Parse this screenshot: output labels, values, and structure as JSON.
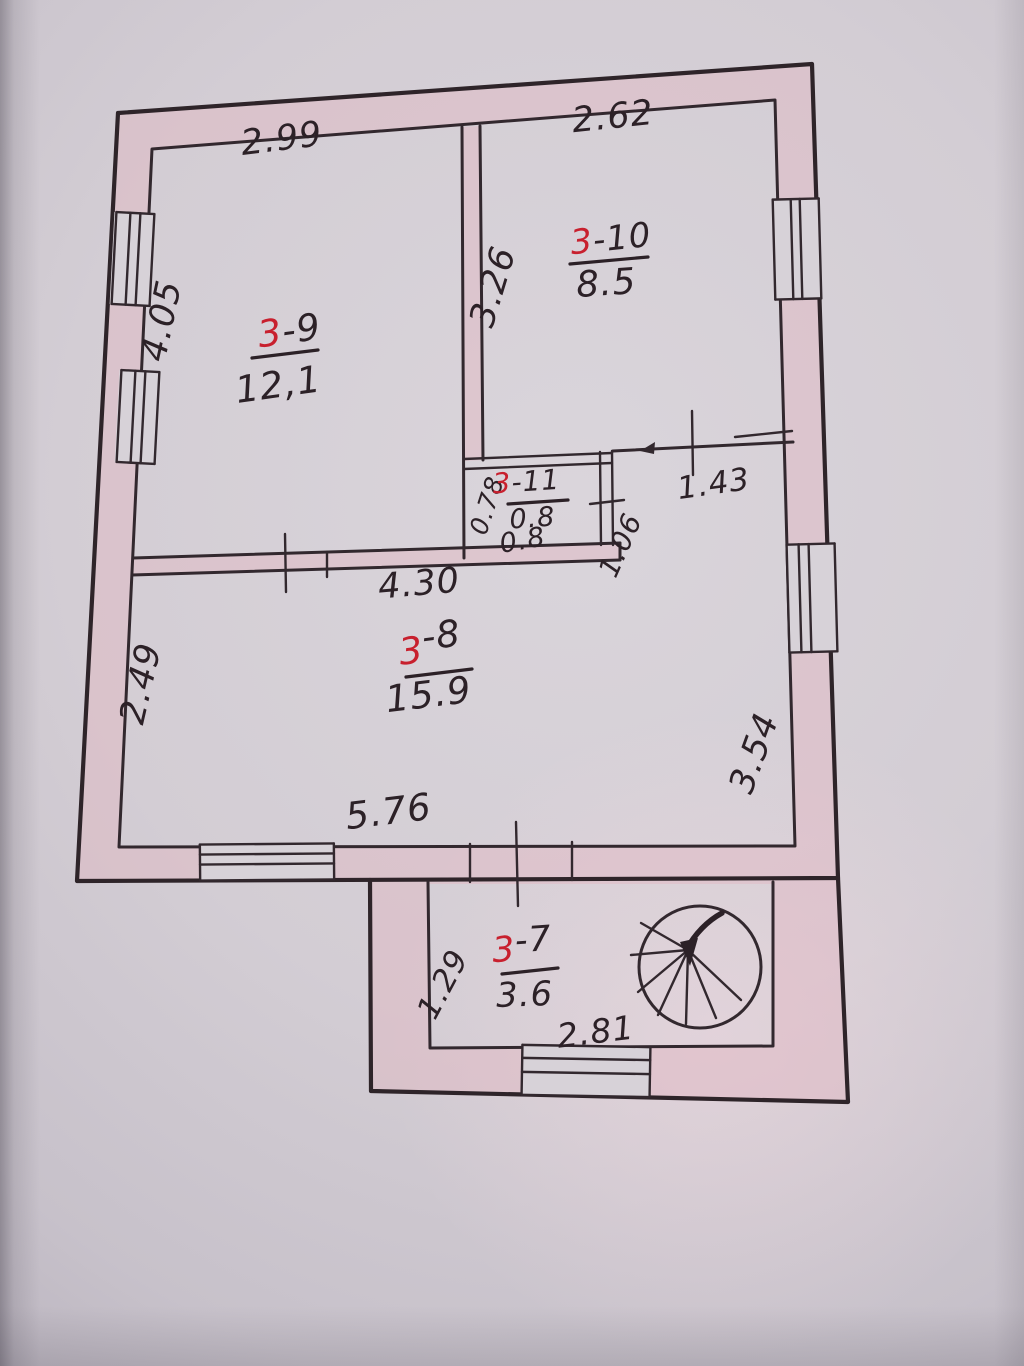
{
  "plan": {
    "rooms": [
      {
        "prefix": "3",
        "suffix": "-9",
        "area": "12,1"
      },
      {
        "prefix": "3",
        "suffix": "-10",
        "area": "8.5"
      },
      {
        "prefix": "3",
        "suffix": "-11",
        "area": "0.8",
        "area_note": "0.8"
      },
      {
        "prefix": "3",
        "suffix": "-8",
        "area": "15.9"
      },
      {
        "prefix": "3",
        "suffix": "-7",
        "area": "3.6"
      }
    ],
    "dimensions": {
      "top_left_width": "2.99",
      "top_right_width": "2.62",
      "left_upper_height": "4.05",
      "partition_height": "3.26",
      "closet_left_height": "0.78",
      "passage_width_right": "1.43",
      "passage_opening": "1.06",
      "mid_wall_width": "4.30",
      "left_lower_height": "2.49",
      "bottom_inner_width": "5.76",
      "right_lower_height": "3.54",
      "porch_left_height": "1.29",
      "porch_bottom_width": "2.81"
    },
    "features": {
      "staircase": "spiral-staircase"
    },
    "colors": {
      "ink": "#32282e",
      "room_number_red": "#c8202e",
      "paper": "#d7d2d8",
      "wall_tint": "#e5c3cc"
    }
  }
}
